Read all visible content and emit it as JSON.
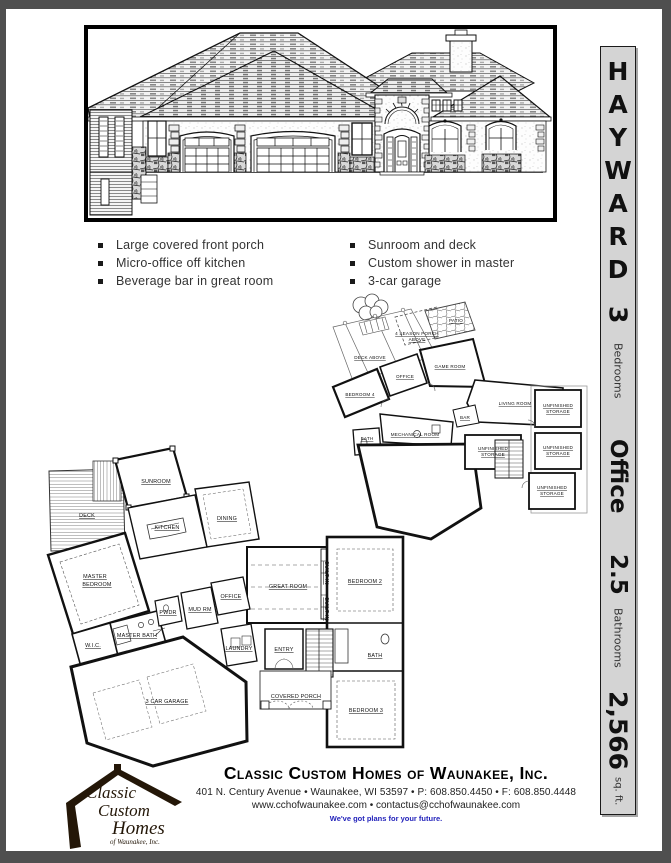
{
  "sidebar": {
    "plan_letters": [
      "H",
      "A",
      "Y",
      "W",
      "A",
      "R",
      "D"
    ],
    "bedrooms_value": "3",
    "bedrooms_label": "Bedrooms",
    "feature_word": "Office",
    "bathrooms_value": "2.5",
    "bathrooms_label": "Bathrooms",
    "sqft_value": "2,566",
    "sqft_label": "sq. ft."
  },
  "features": {
    "left": [
      "Large covered front porch",
      "Micro-office off kitchen",
      "Beverage bar in great room"
    ],
    "right": [
      "Sunroom and deck",
      "Custom shower in master",
      "3-car garage"
    ]
  },
  "plans": {
    "lower": {
      "labels": [
        "4 SEASON PORCH",
        "ABOVE",
        "PATIO",
        "DECK ABOVE",
        "GAME ROOM",
        "OFFICE",
        "BEDROOM 4",
        "LIVING ROOM",
        "BAR",
        "MECHANICAL ROOM",
        "BATH",
        "UNFINISHED",
        "STORAGE",
        "UNFINISHED",
        "STORAGE",
        "UNFINISHED",
        "STORAGE",
        "UNFINISHED",
        "STORAGE"
      ]
    },
    "main": {
      "labels": [
        "SUNROOM",
        "DECK",
        "KITCHEN",
        "DINING",
        "MASTER",
        "BEDROOM",
        "GREAT ROOM",
        "OFFICE",
        "PWDR",
        "MUD RM",
        "W.I.C.",
        "MASTER BATH",
        "LAUNDRY",
        "ENTRY",
        "3 CAR GARAGE",
        "COVERED PORCH",
        "BATH",
        "BEDROOM 3",
        "BEDROOM 2",
        "BUILT-IN",
        "BUILT-IN"
      ]
    }
  },
  "footer": {
    "logo_line1": "Classic",
    "logo_line2": "Custom",
    "logo_line3": "Homes",
    "logo_line4": "of Waunakee, Inc.",
    "company": "Classic Custom Homes of Waunakee, Inc.",
    "address": "401 N. Century Avenue • Waunakee, WI 53597 • P: 608.850.4450 • F: 608.850.4448",
    "web": "www.cchofwaunakee.com • contactus@cchofwaunakee.com",
    "tagline": "We've got  plans for your future."
  },
  "colors": {
    "surround": "#4f4f4f",
    "sidebar_bg": "#d4d4d4",
    "tagline_blue": "#2323bb",
    "logo_brown": "#241708"
  }
}
